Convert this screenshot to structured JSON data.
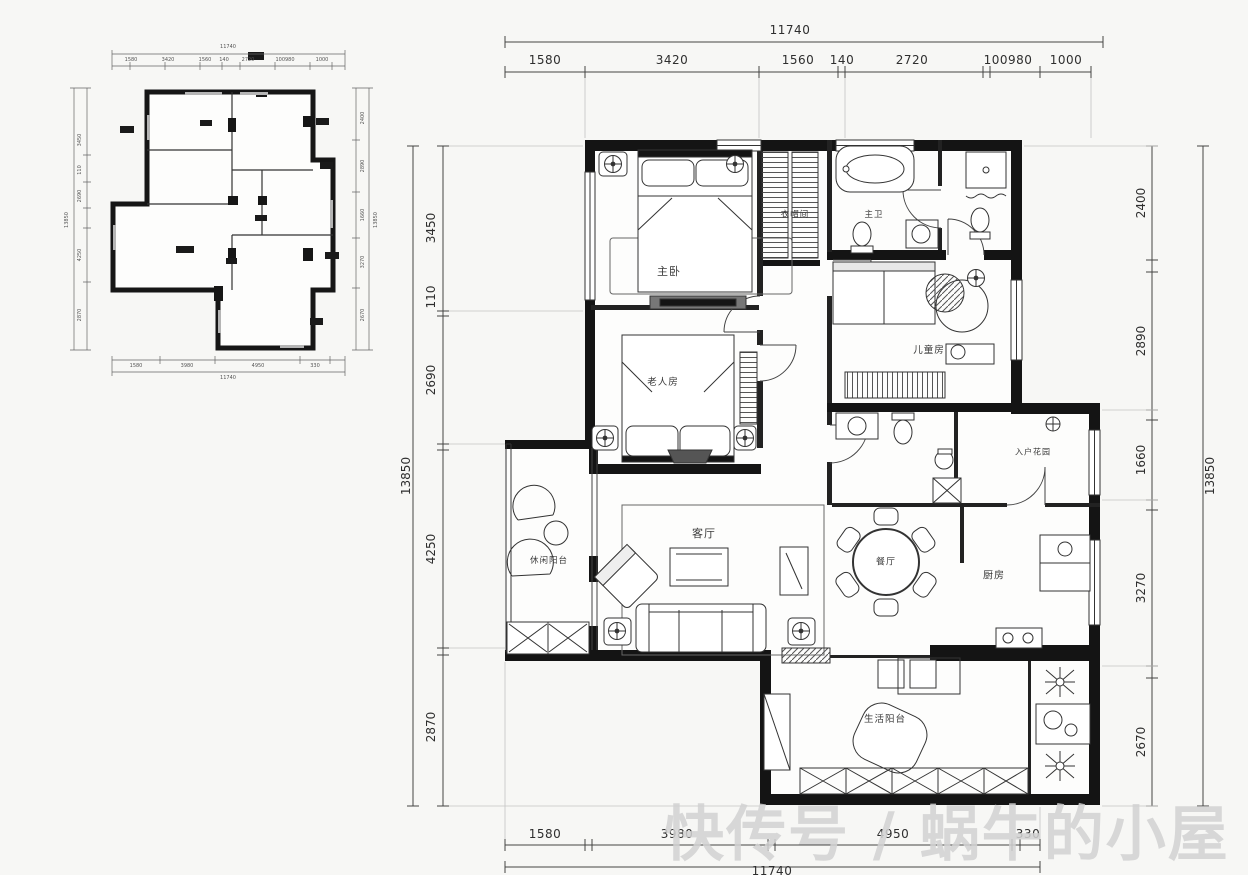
{
  "watermark": {
    "text": "快传号 / 蜗牛的小屋"
  },
  "main_plan": {
    "dims_top": {
      "total": "11740",
      "segments": [
        "1580",
        "3420",
        "1560",
        "140",
        "2720",
        "100980",
        "1000"
      ]
    },
    "dims_left": {
      "total": "13850",
      "segments": [
        "3450",
        "110",
        "2690",
        "4250",
        "2870"
      ]
    },
    "dims_right": {
      "total": "13850",
      "segments": [
        "2400",
        "2890",
        "1660",
        "3270",
        "2670"
      ]
    },
    "dims_bottom": {
      "total": "11740",
      "segments": [
        "1580",
        "3980",
        "4950",
        "330"
      ]
    },
    "rooms": {
      "master_bedroom": "主卧",
      "cloakroom": "衣帽间",
      "master_bath": "主卫",
      "kids_room": "儿童房",
      "elder_room": "老人房",
      "living_room": "客厅",
      "leisure_balcony": "休闲阳台",
      "dining_room": "餐厅",
      "kitchen": "厨房",
      "entry_garden": "入户花园",
      "service_balcony": "生活阳台"
    }
  }
}
